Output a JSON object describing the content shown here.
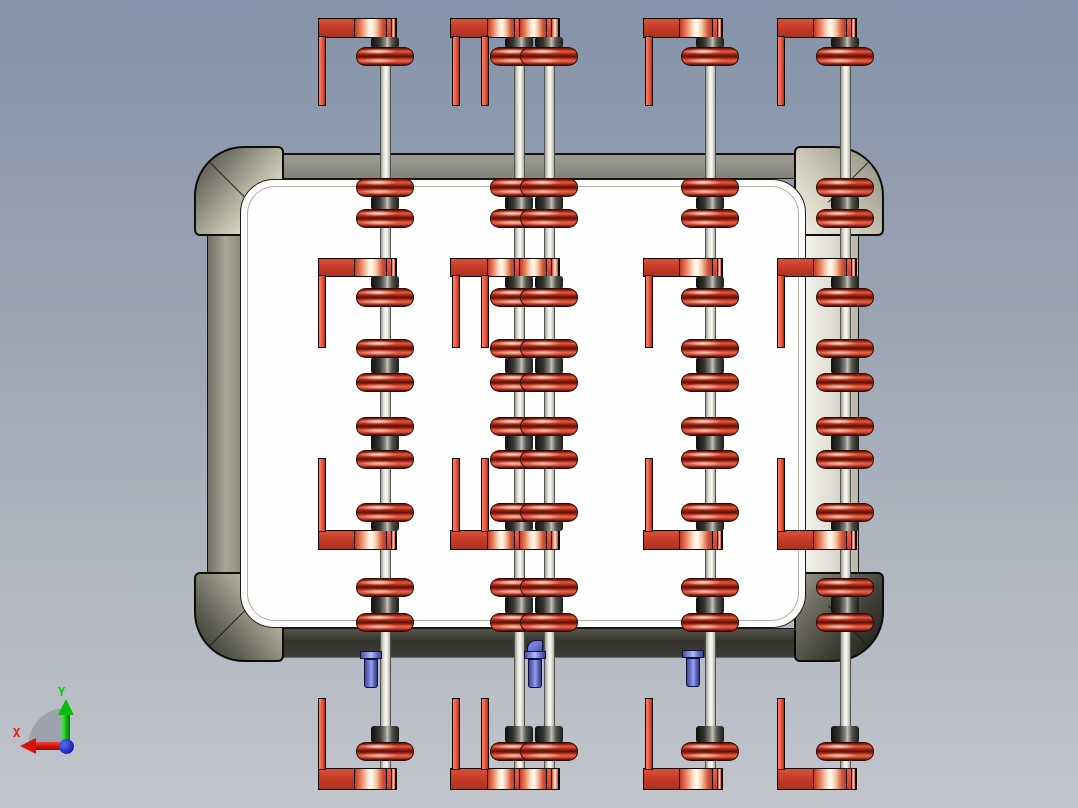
{
  "viewport": {
    "width": 1078,
    "height": 808,
    "description": "CAD front view of pulley-block housing assembly"
  },
  "triad": {
    "x_label": "X",
    "y_label": "Y"
  },
  "palette": {
    "bg_top": "#8493a9",
    "bg_bottom": "#c1c5cc",
    "white_int": "#fefefe",
    "khaki": "#b5b2a1",
    "red_base": "#c23a26",
    "red_bright": "#ea6448",
    "red_deep": "#5a1008",
    "cream": "#fff0dc",
    "rod_light": "#fbfbf6",
    "hub_dark": "#171715",
    "blue_main": "#6a74d6",
    "axis_x": "#e02010",
    "axis_y": "#00d000",
    "axis_z": "#2a32c4"
  },
  "model": {
    "rod_w": 11,
    "rod_span": [
      40,
      786
    ],
    "hub_w": 28,
    "sheave_w": 58,
    "sheave_h": 19,
    "leg_w": 8,
    "sheaves_y": [
      47,
      178,
      209,
      288,
      339,
      373,
      417,
      450,
      503,
      578,
      613,
      742
    ],
    "hubs": [
      [
        37,
        11
      ],
      [
        196,
        14
      ],
      [
        276,
        13
      ],
      [
        357,
        17
      ],
      [
        434,
        17
      ],
      [
        520,
        11
      ],
      [
        596,
        18
      ],
      [
        726,
        17
      ]
    ],
    "brackets": [
      {
        "bar_y": 18,
        "bar_h": 20,
        "leg_y": 36,
        "leg_h": 70
      },
      {
        "bar_y": 258,
        "bar_h": 19,
        "leg_y": 275,
        "leg_h": 73
      },
      {
        "bar_y": 530,
        "bar_h": 20,
        "leg_y": 458,
        "leg_h": 74
      },
      {
        "bar_y": 768,
        "bar_h": 22,
        "leg_y": 698,
        "leg_h": 72
      }
    ],
    "bar_segments": {
      "single": [
        [
          "flat",
          0.465
        ],
        [
          "shine",
          0.415
        ],
        [
          "thin",
          0.065
        ],
        [
          "shine2",
          0.055
        ]
      ],
      "double": [
        [
          "flat",
          0.345
        ],
        [
          "shine",
          0.25
        ],
        [
          "thin",
          0.045
        ],
        [
          "shine",
          0.25
        ],
        [
          "thin",
          0.045
        ],
        [
          "shine2",
          0.065
        ]
      ]
    },
    "columns": [
      {
        "name": "rod-column-1",
        "rods": [
          385
        ],
        "bar_x": 318,
        "bar_w": 79,
        "legs": [
          318
        ],
        "seg_style": "single"
      },
      {
        "name": "rod-column-2",
        "rods": [
          519,
          549
        ],
        "bar_x": 450,
        "bar_w": 110,
        "legs": [
          452,
          481
        ],
        "seg_style": "double"
      },
      {
        "name": "rod-column-3",
        "rods": [
          710
        ],
        "bar_x": 643,
        "bar_w": 80,
        "legs": [
          645
        ],
        "seg_style": "single"
      },
      {
        "name": "rod-column-4",
        "rods": [
          845
        ],
        "bar_x": 777,
        "bar_w": 80,
        "legs": [
          777
        ],
        "seg_style": "single"
      }
    ],
    "bushings": [
      {
        "cx": 371,
        "top": 651,
        "cap": false
      },
      {
        "cx": 535,
        "top": 651,
        "cap": true
      },
      {
        "cx": 693,
        "top": 650,
        "cap": false
      }
    ]
  }
}
